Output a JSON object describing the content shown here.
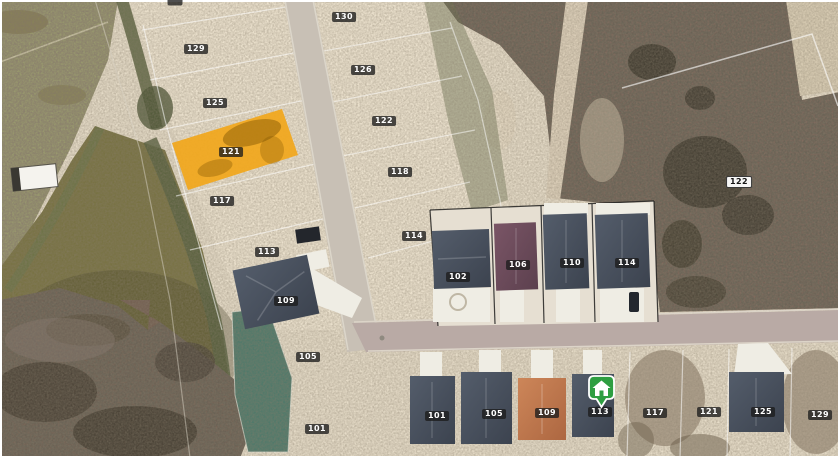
{
  "map": {
    "type": "aerial-parcel-map",
    "highlight": {
      "parcel": "121",
      "color": "#F1A71C"
    },
    "marker": {
      "name": "listing-house-marker",
      "color": "#2E9E41"
    },
    "colors": {
      "sand": "#E6DCC8",
      "lots_sand": "#EDE3CF",
      "grass": "#99996E",
      "water": "#787243",
      "scrub": "#80665A",
      "brush": "#746052",
      "road_diagonal": "#C8C0B5",
      "road_horizontal": "#B9AAA5",
      "roof_slate": "#47505C",
      "roof_maroon": "#6E4C5B",
      "roof_terracotta": "#C07950",
      "concrete": "#EFEDE4"
    },
    "parcel_labels": [
      {
        "text": "130",
        "x": 344,
        "y": 17,
        "style": "dark"
      },
      {
        "text": "129",
        "x": 196,
        "y": 49,
        "style": "dark"
      },
      {
        "text": "126",
        "x": 363,
        "y": 70,
        "style": "dark"
      },
      {
        "text": "125",
        "x": 215,
        "y": 103,
        "style": "dark"
      },
      {
        "text": "122",
        "x": 384,
        "y": 121,
        "style": "dark"
      },
      {
        "text": "121",
        "x": 231,
        "y": 152,
        "style": "dark"
      },
      {
        "text": "118",
        "x": 400,
        "y": 172,
        "style": "dark"
      },
      {
        "text": "122",
        "x": 739,
        "y": 182,
        "style": "light"
      },
      {
        "text": "117",
        "x": 222,
        "y": 201,
        "style": "dark"
      },
      {
        "text": "114",
        "x": 414,
        "y": 236,
        "style": "dark"
      },
      {
        "text": "113",
        "x": 267,
        "y": 252,
        "style": "dark"
      },
      {
        "text": "110",
        "x": 572,
        "y": 263,
        "style": "dark"
      },
      {
        "text": "114",
        "x": 627,
        "y": 263,
        "style": "dark"
      },
      {
        "text": "106",
        "x": 518,
        "y": 265,
        "style": "dark"
      },
      {
        "text": "102",
        "x": 458,
        "y": 277,
        "style": "dark"
      },
      {
        "text": "109",
        "x": 286,
        "y": 301,
        "style": "dark"
      },
      {
        "text": "105",
        "x": 308,
        "y": 357,
        "style": "dark"
      },
      {
        "text": "113",
        "x": 600,
        "y": 412,
        "style": "dark"
      },
      {
        "text": "121",
        "x": 709,
        "y": 412,
        "style": "dark"
      },
      {
        "text": "125",
        "x": 763,
        "y": 412,
        "style": "dark"
      },
      {
        "text": "109",
        "x": 547,
        "y": 413,
        "style": "dark"
      },
      {
        "text": "117",
        "x": 655,
        "y": 413,
        "style": "dark"
      },
      {
        "text": "105",
        "x": 494,
        "y": 414,
        "style": "dark"
      },
      {
        "text": "129",
        "x": 820,
        "y": 415,
        "style": "dark"
      },
      {
        "text": "101",
        "x": 437,
        "y": 416,
        "style": "dark"
      },
      {
        "text": "101",
        "x": 317,
        "y": 429,
        "style": "dark"
      },
      {
        "text": "",
        "x": 175,
        "y": 2,
        "style": "dark",
        "partial": true
      }
    ]
  }
}
